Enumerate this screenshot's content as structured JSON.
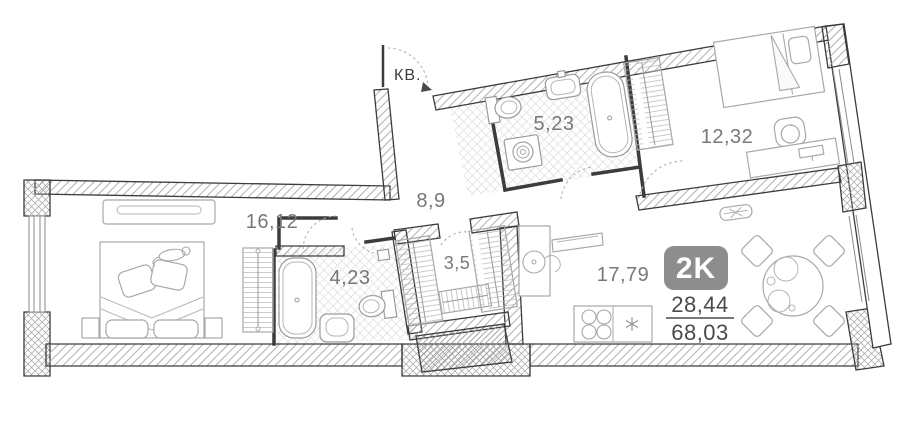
{
  "plan": {
    "entrance_label": "КВ.",
    "type_badge": "2K",
    "living_area": "28,44",
    "total_area": "68,03",
    "rooms": {
      "bedroom_left": "16,12",
      "hallway": "8,9",
      "bathroom_top": "5,23",
      "bedroom_right": "12,32",
      "bathroom_small": "4,23",
      "wardrobe_room": "3,5",
      "kitchen_living": "17,79"
    }
  },
  "colors": {
    "wall_line": "#3c3c3c",
    "hatch": "#a6a6a6",
    "room_label": "#787878",
    "area_text": "#4a4a4a",
    "badge_bg": "#8d8d8d",
    "badge_text": "#ffffff",
    "furniture": "#a8a8a8"
  }
}
